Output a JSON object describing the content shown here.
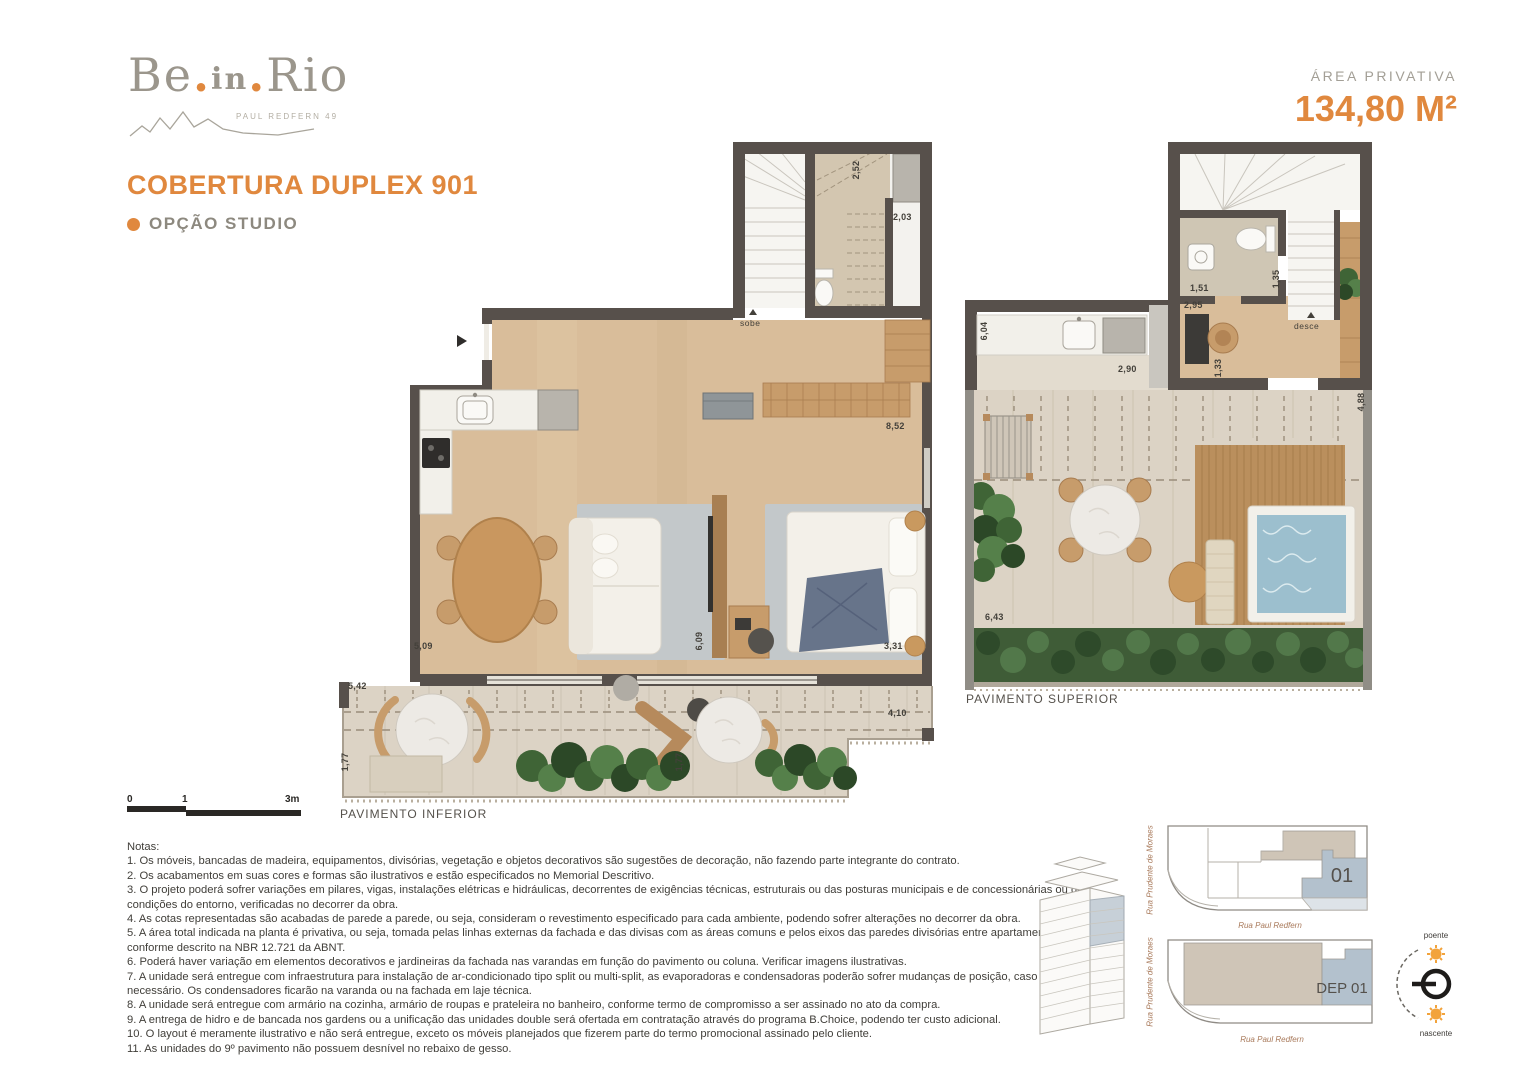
{
  "header": {
    "logo": {
      "part1": "Be",
      "dot1": ".",
      "part2": "in",
      "dot2": ".",
      "part3": "Rio",
      "tagline": "PAUL REDFERN 49"
    },
    "title": "COBERTURA DUPLEX 901",
    "option_label": "OPÇÃO STUDIO",
    "area_label": "ÁREA PRIVATIVA",
    "area_value": "134,80 M²"
  },
  "plans": {
    "inferior": {
      "label": "PAVIMENTO INFERIOR",
      "stair_label": "sobe",
      "dims": {
        "w252": "2,52",
        "w203": "2,03",
        "w852": "8,52",
        "w509": "5,09",
        "w609": "6,09",
        "w331": "3,31",
        "w542": "5,42",
        "w177a": "1,77",
        "w177b": "1,77",
        "w410": "4,10"
      }
    },
    "superior": {
      "label": "PAVIMENTO SUPERIOR",
      "stair_label": "desce",
      "dims": {
        "w604": "6,04",
        "w290": "2,90",
        "w295": "2,95",
        "w151": "1,51",
        "w135": "1,35",
        "w133": "1,33",
        "w488": "4,88",
        "w643": "6,43"
      }
    }
  },
  "scale_bar": {
    "tick0": "0",
    "tick1": "1",
    "tick2": "3m"
  },
  "notes": {
    "heading": "Notas:",
    "items": [
      "1. Os móveis, bancadas de madeira, equipamentos, divisórias, vegetação e objetos decorativos são sugestões de decoração, não fazendo parte integrante do contrato.",
      "2. Os acabamentos em suas cores e formas são ilustrativos e estão especificados no Memorial Descritivo.",
      "3. O projeto poderá sofrer variações em pilares, vigas, instalações elétricas e hidráulicas, decorrentes de exigências técnicas, estruturais ou das posturas municipais e de concessionárias ou de condições do entorno, verificadas no decorrer da obra.",
      "4. As cotas representadas são acabadas de parede a parede, ou seja, consideram o revestimento especificado para cada ambiente, podendo sofrer alterações no decorrer da obra.",
      "5. A área total indicada na planta é privativa, ou seja, tomada pelas linhas externas da fachada e das divisas com as áreas comuns e pelos eixos das paredes divisórias entre apartamentos, conforme descrito na NBR 12.721 da ABNT.",
      "6. Poderá haver variação em elementos decorativos e jardineiras da fachada nas varandas em função do pavimento ou coluna. Verificar imagens ilustrativas.",
      "7. A unidade será entregue com infraestrutura para instalação de ar-condicionado tipo split ou multi-split, as evaporadoras e condensadoras poderão sofrer mudanças de posição, caso necessário. Os condensadores ficarão na varanda ou na fachada em laje técnica.",
      "8. A unidade será entregue com armário na cozinha, armário de roupas e prateleira no banheiro, conforme termo de compromisso a ser assinado no ato da compra.",
      "9. A entrega de hidro e de bancada nos gardens ou a unificação das unidades double será ofertada em contratação através do programa B.Choice, podendo ter custo adicional.",
      "10. O layout é meramente ilustrativo e não será entregue, exceto os móveis planejados que fizerem parte do termo promocional assinado pelo cliente.",
      "11. As unidades do 9º pavimento não possuem desnível no rebaixo de gesso."
    ]
  },
  "key_plans": {
    "street_left": "Rua Prudente de Moraes",
    "street_bottom": "Rua Paul Redfern",
    "unit_floor": "01",
    "unit_dep": "DEP 01"
  },
  "compass": {
    "top": "poente",
    "bottom": "nascente"
  },
  "colors": {
    "accent": "#E0883E",
    "wall": "#57504B",
    "wood": "#D9BD9A",
    "terrace": "#DCD3C5",
    "pool": "#9CBFCE",
    "keyplan_blue": "#B3C1CD",
    "keyplan_beige": "#CFC5B7"
  }
}
